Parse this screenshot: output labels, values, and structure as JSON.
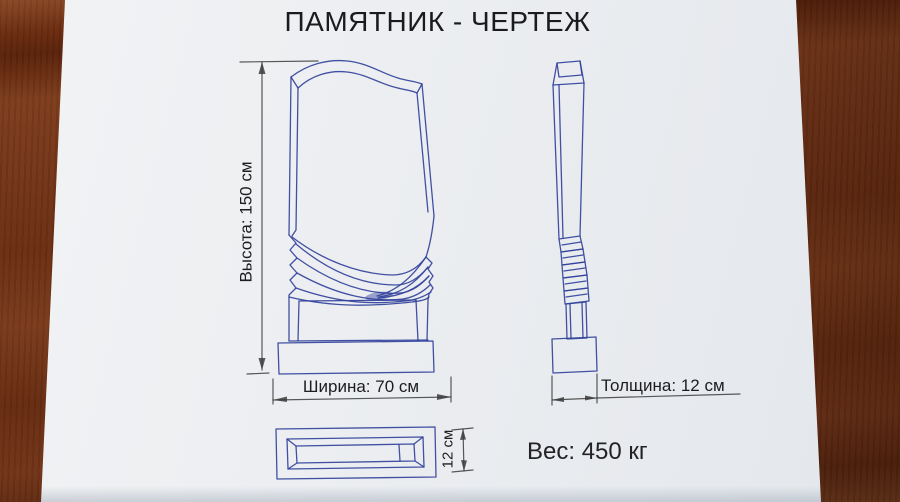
{
  "title": "ПАМЯТНИК - ЧЕРТЕЖ",
  "views": {
    "front": {
      "height_label": "Высота: 150 см",
      "width_label": "Ширина: 70 см"
    },
    "side": {
      "thickness_label": "Толщина: 12 см"
    },
    "plinth": {
      "height_label": "12 см"
    }
  },
  "weight_label": "Вес: 450 кг",
  "values": {
    "height_cm": 150,
    "width_cm": 70,
    "thickness_cm": 12,
    "plinth_height_cm": 12,
    "weight_kg": 450
  },
  "colors": {
    "ink_blue": "#32429b",
    "dimension_gray": "#3c3c3c",
    "paper": "#eceef1",
    "wood_brown": "#6f3114"
  }
}
